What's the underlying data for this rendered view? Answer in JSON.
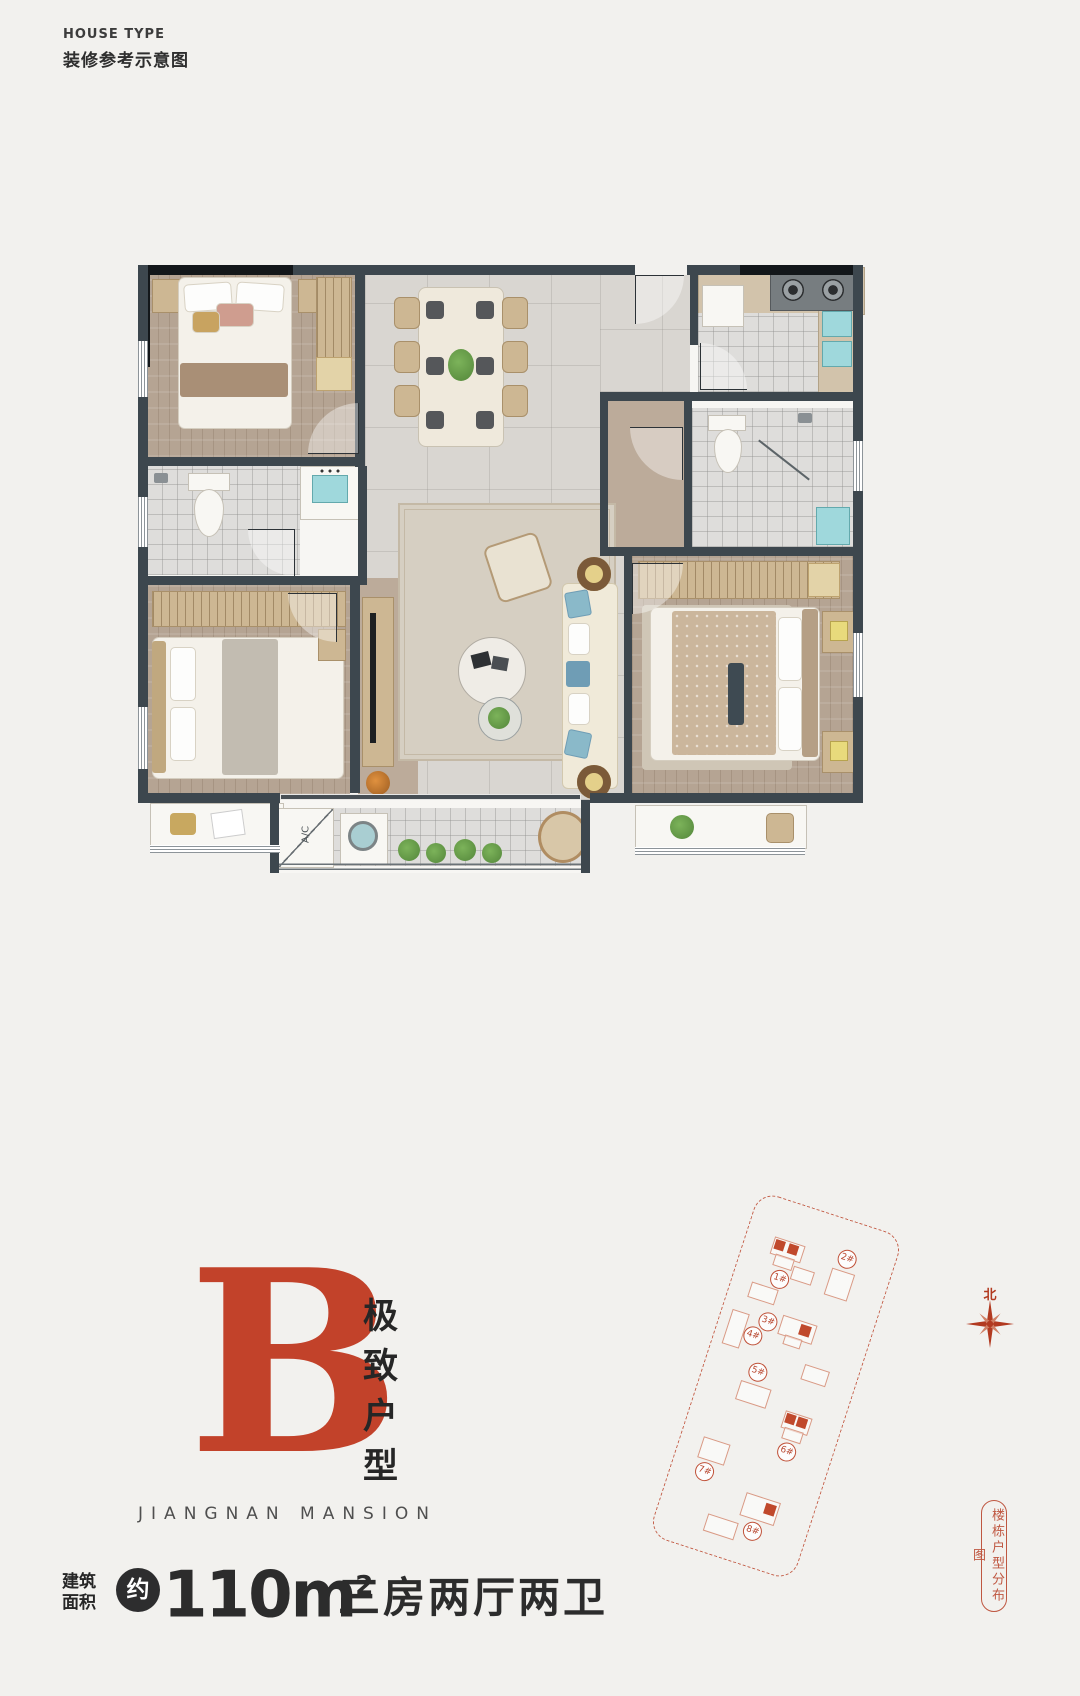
{
  "header": {
    "eyebrow": "HOUSE TYPE",
    "title": "装修参考示意图"
  },
  "hero": {
    "letter": "B",
    "tagline": "极致户型",
    "brand": "JIANGNAN MANSION"
  },
  "specs": {
    "area_label_top": "建筑",
    "area_label_bottom": "面积",
    "approx_badge": "约",
    "area_value": "110m",
    "area_exponent": "2",
    "layout": "三房两厅两卫"
  },
  "floor_plan": {
    "ac_label": "A/C"
  },
  "site_plan": {
    "north": "北",
    "caption": "楼栋户型分布图",
    "buildings": [
      "1#",
      "2#",
      "3#",
      "4#",
      "5#",
      "6#",
      "7#",
      "8#"
    ]
  },
  "colors": {
    "accent_red": "#c2422a",
    "site_plan_red": "#c4604a",
    "wall_gray": "#3d474e",
    "wall_black": "#13171a"
  }
}
